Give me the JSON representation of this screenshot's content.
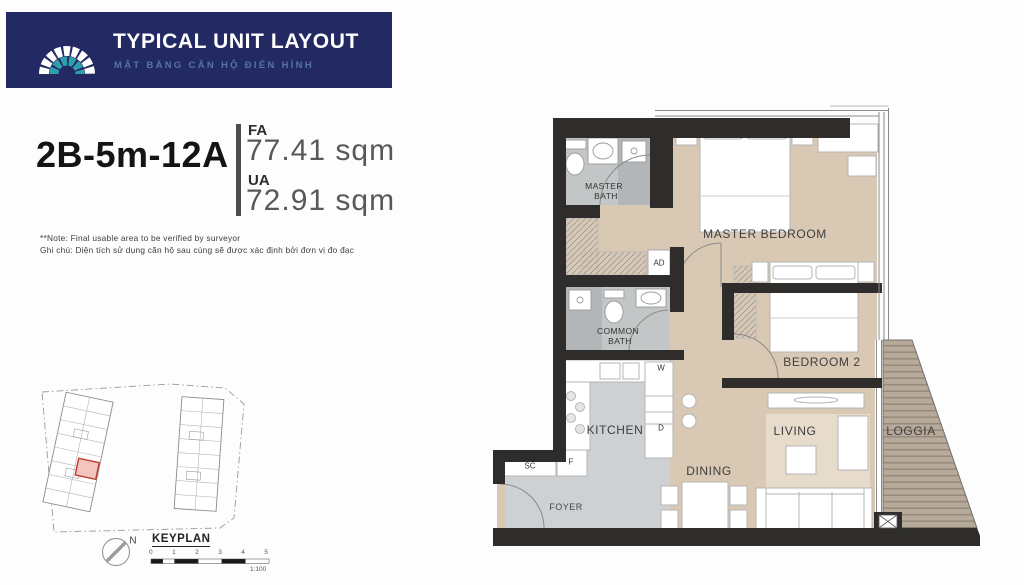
{
  "header": {
    "title": "TYPICAL UNIT LAYOUT",
    "subtitle": "MẶT BẰNG CĂN HỘ ĐIỂN HÌNH",
    "brand_navy": "#232a63",
    "brand_teal": "#2e9fae"
  },
  "unit": {
    "code": "2B-5m-12A",
    "fa_label": "FA",
    "fa_value": "77.41 sqm",
    "ua_label": "UA",
    "ua_value": "72.91 sqm"
  },
  "notes": {
    "line1": "**Note: Final usable area to be verified by surveyor",
    "line2": "Ghi chú: Diện tích sử dụng căn hộ sau cùng sẽ được xác định bởi đơn vị đo đạc"
  },
  "keyplan": {
    "title": "KEYPLAN",
    "north_label": "N",
    "scale_ticks": [
      "0",
      "1",
      "2",
      "3",
      "4",
      "5"
    ],
    "scale_ratio": "1:100",
    "highlight_color": "#c23b2e"
  },
  "plan": {
    "rooms": {
      "master_bedroom": "MASTER BEDROOM",
      "bedroom2": "BEDROOM 2",
      "living": "LIVING",
      "dining": "DINING",
      "kitchen": "KITCHEN",
      "loggia": "LOGGIA",
      "foyer": "FOYER",
      "master_bath_line1": "MASTER",
      "master_bath_line2": "BATH",
      "common_bath_line1": "COMMON",
      "common_bath_line2": "BATH"
    },
    "tags": {
      "ad": "AD",
      "washer": "W",
      "dryer": "D",
      "shoe_cabinet": "SC",
      "fridge": "F"
    },
    "colors": {
      "wall": "#2e2d2b",
      "wood_floor": "#d9c8b4",
      "tile_floor": "#c3c6c7",
      "gray_floor": "#cdd1d4",
      "deck": "#b7aa9b"
    }
  }
}
